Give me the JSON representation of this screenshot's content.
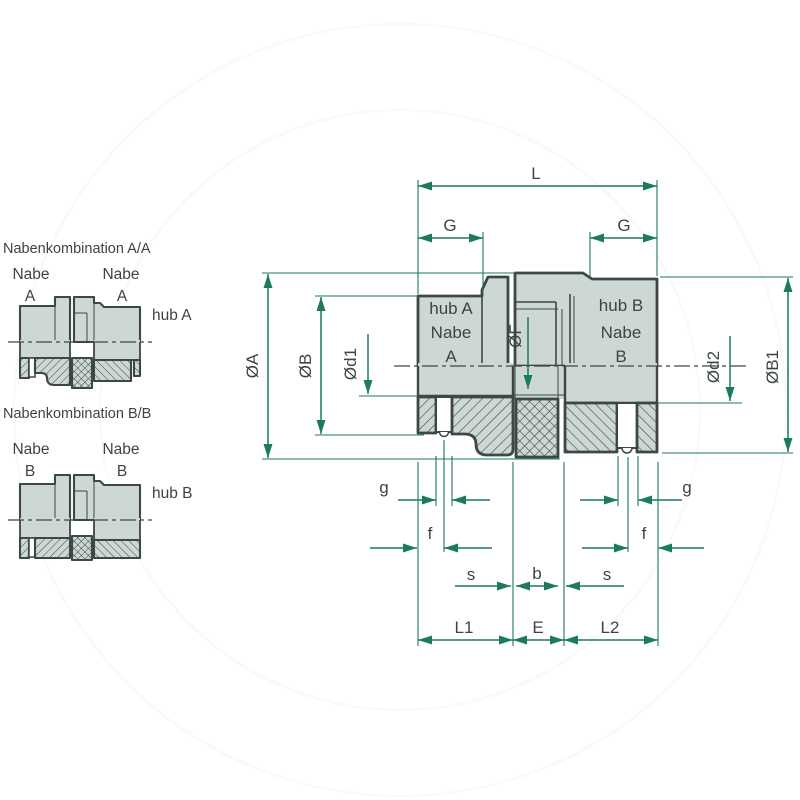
{
  "colors": {
    "dimension_line": "#1b7a5f",
    "drawing_ink": "#3d4744",
    "part_fill": "#cdd8d3",
    "background": "#ffffff"
  },
  "combo_a": {
    "title": "Nabenkombination A/A",
    "nabe_left": "Nabe",
    "id_left": "A",
    "nabe_right": "Nabe",
    "id_right": "A",
    "hub_label": "hub A"
  },
  "combo_b": {
    "title": "Nabenkombination  B/B",
    "nabe_left": "Nabe",
    "id_left": "B",
    "nabe_right": "Nabe",
    "id_right": "B",
    "hub_label": "hub B"
  },
  "main": {
    "hub_a": {
      "line1": "hub A",
      "line2": "Nabe",
      "line3": "A"
    },
    "hub_b": {
      "line1": "hub B",
      "line2": "Nabe",
      "line3": "B"
    },
    "dims": {
      "L": "L",
      "G_left": "G",
      "G_right": "G",
      "phiA": "ØA",
      "phiB": "ØB",
      "phid1": "Ød1",
      "phiF": "ØF",
      "phid2": "Ød2",
      "phiB1": "ØB1",
      "g_left": "g",
      "g_right": "g",
      "f_left": "f",
      "f_right": "f",
      "s_left": "s",
      "s_right": "s",
      "b": "b",
      "L1": "L1",
      "E": "E",
      "L2": "L2"
    }
  }
}
